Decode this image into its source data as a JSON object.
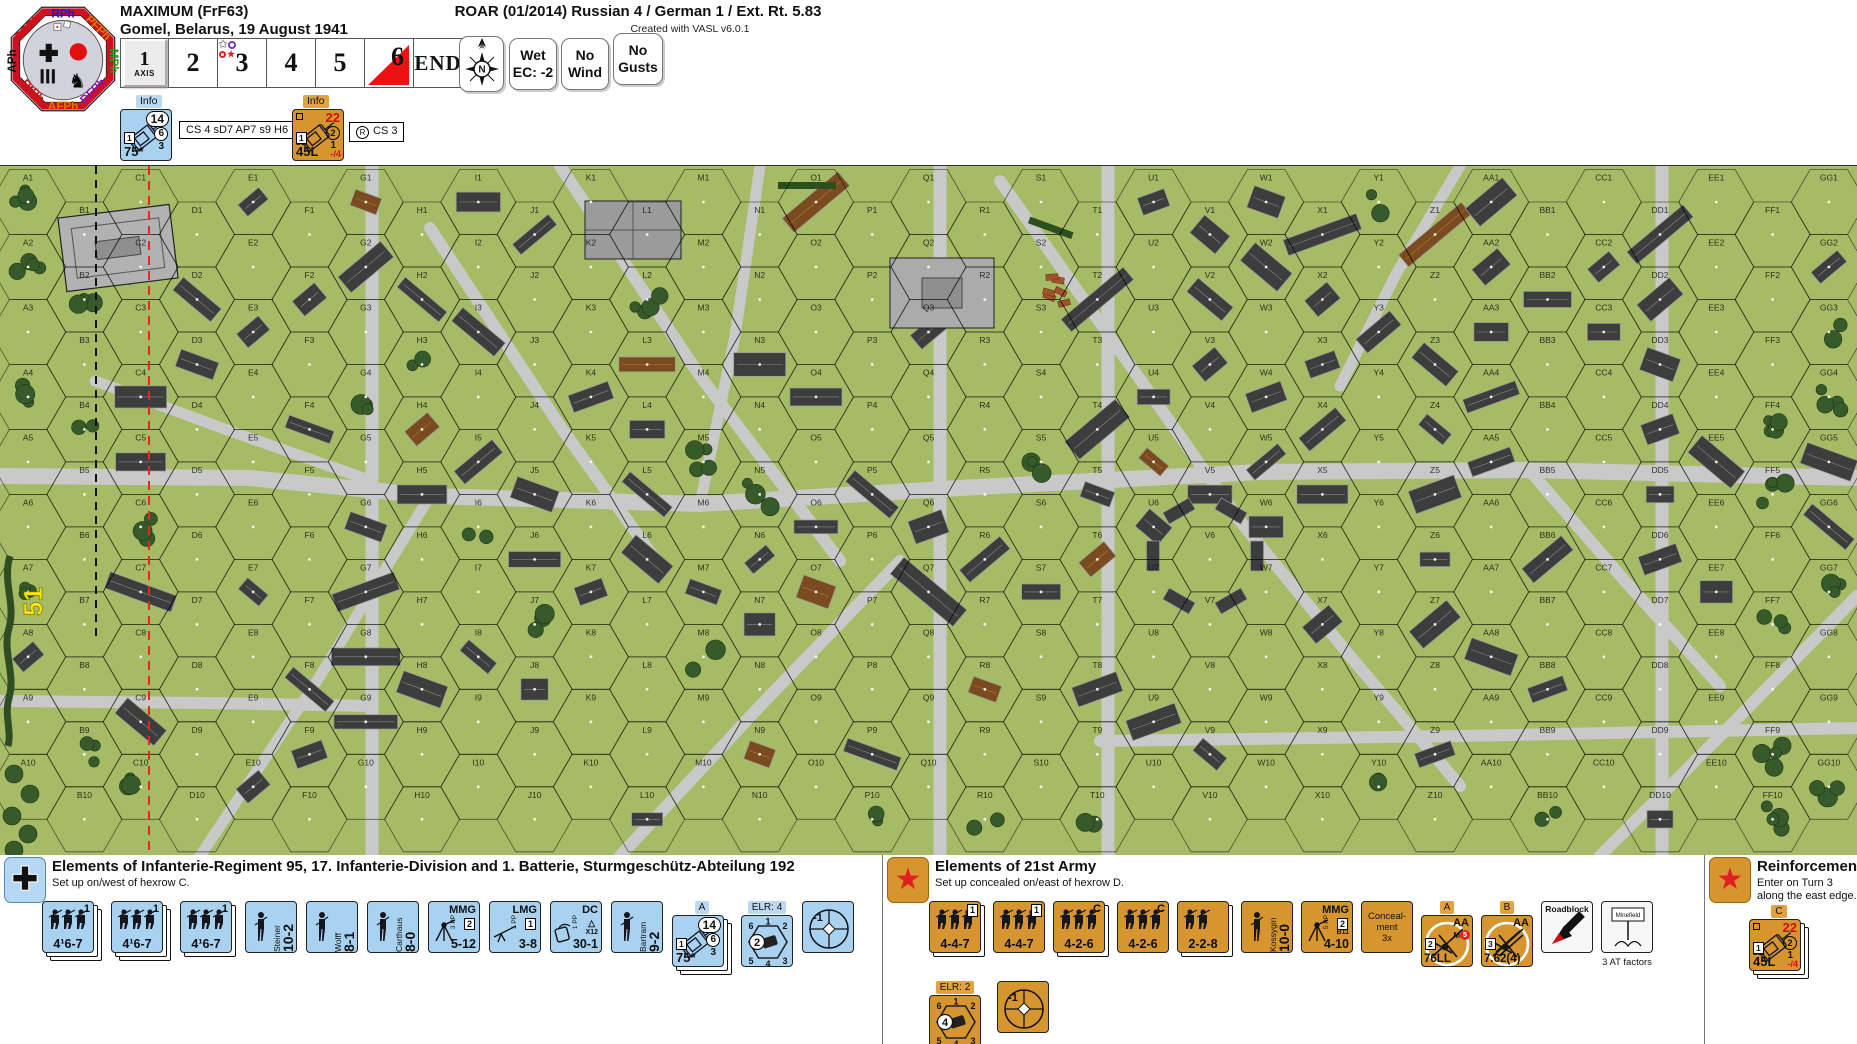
{
  "colors": {
    "map_green": "#a6bb66",
    "road_gray": "#c9c9c9",
    "german_blue": "#a9d2f0",
    "russian_orange": "#d6952f",
    "alert_red": "#e01010"
  },
  "header": {
    "scenario_title": "MAXIMUM (FrF63)",
    "scenario_location": "Gomel, Belarus, 19 August 1941",
    "roar_line": "ROAR (01/2014) Russian 4 / German 1 / Ext. Rt. 5.83",
    "created_with": "Created with VASL v6.0.1",
    "turn_track": {
      "cells": [
        "1",
        "2",
        "3",
        "4",
        "5",
        "6",
        "END"
      ],
      "axis_label": "AXIS",
      "current_turn_cell": "6",
      "reinforcement_turn_cell": "3"
    },
    "weather": {
      "compass": "N",
      "wet": [
        "Wet",
        "EC: -2"
      ],
      "wind": [
        "No",
        "Wind"
      ],
      "gusts": [
        "No",
        "Gusts"
      ]
    },
    "info_german": {
      "label": "Info",
      "counter": {
        "t": "vehicle",
        "stack": 1,
        "pills": [
          "14",
          "6",
          "3"
        ],
        "box": "1",
        "gun": "75*"
      },
      "note": "CS 4  sD7  AP7  s9  H6"
    },
    "info_russian": {
      "label": "Info",
      "counter": {
        "t": "vehicle",
        "stack": 1,
        "red": "22",
        "circ": "2",
        "low": "1",
        "box": "1",
        "sub": "B11",
        "gun": "45L",
        "brk": "-/4"
      },
      "note": "CS 3"
    }
  },
  "phase_wheel": {
    "phases": [
      {
        "label": "RPh",
        "color": "#1818e0"
      },
      {
        "label": "PFPh",
        "color": "#e07800"
      },
      {
        "label": "MPh",
        "color": "#18a018"
      },
      {
        "label": "DFPh",
        "color": "#9010b0"
      },
      {
        "label": "AFPh",
        "color": "#e07800"
      },
      {
        "label": "RtPh",
        "color": "#d01010"
      },
      {
        "label": "APh",
        "color": "#101010"
      },
      {
        "label": "CCPh",
        "color": "#d01010"
      }
    ]
  },
  "map": {
    "columns": [
      "A",
      "B",
      "C",
      "D",
      "E",
      "F",
      "G",
      "H",
      "I",
      "J",
      "K",
      "L",
      "M",
      "N",
      "O",
      "P",
      "Q",
      "R",
      "S",
      "T",
      "U",
      "V",
      "W",
      "X",
      "Y",
      "Z",
      "AA",
      "BB",
      "CC",
      "DD",
      "EE",
      "FF",
      "GG"
    ],
    "rows": 10,
    "edge_label": "51"
  },
  "german_ob": {
    "title": "Elements of Infanterie-Regiment 95, 17. Infanterie-Division and 1. Batterie, Sturmgeschütz-Abteilung 192",
    "setup": "Set up on/west of hexrow C.",
    "counters": [
      {
        "t": "squad",
        "stack": 3,
        "fv": "4¹6-7",
        "badge": "1",
        "boxed": false
      },
      {
        "t": "squad",
        "stack": 3,
        "fv": "4¹6-7",
        "badge": "1",
        "boxed": false
      },
      {
        "t": "squad",
        "stack": 2,
        "fv": "4¹6-7",
        "badge": "1",
        "boxed": false
      },
      {
        "t": "leader",
        "name": "Steiner",
        "rating": "10-2"
      },
      {
        "t": "leader",
        "name": "Wolff",
        "rating": "8-1"
      },
      {
        "t": "leader",
        "name": "Carthaus",
        "rating": "8-0"
      },
      {
        "t": "sw",
        "title": "MMG",
        "pp": "3 PP",
        "box": "2",
        "fv": "5-12"
      },
      {
        "t": "sw",
        "title": "LMG",
        "pp": "1 PP",
        "box": "1",
        "fv": "3-8"
      },
      {
        "t": "sw",
        "title": "DC",
        "pp": "1 PP",
        "extra": "X12",
        "fv": "30-1"
      },
      {
        "t": "leader",
        "name": "Bartram",
        "rating": "9-2"
      },
      {
        "t": "vehicle",
        "label": "A",
        "stack": 3,
        "pills": [
          "14",
          "6",
          "3"
        ],
        "box": "1",
        "gun": "75*"
      },
      {
        "t": "turret",
        "label": "ELR: 4",
        "circ": "2"
      },
      {
        "t": "sniper",
        "val": "-1"
      }
    ]
  },
  "russian_ob": {
    "title": "Elements of 21st Army",
    "setup": "Set up concealed on/east of hexrow D.",
    "counters_row1": [
      {
        "t": "squad",
        "stack": 2,
        "fv": "4-4-7",
        "badge": "1",
        "boxed": true
      },
      {
        "t": "squad",
        "stack": 1,
        "fv": "4-4-7",
        "badge": "1",
        "boxed": true
      },
      {
        "t": "squad",
        "stack": 2,
        "fv": "4-2-6",
        "badge": "C",
        "boxed": false
      },
      {
        "t": "squad",
        "stack": 1,
        "fv": "4-2-6",
        "badge": "C",
        "boxed": false
      },
      {
        "t": "squad",
        "stack": 2,
        "fv": "2-2-8",
        "badge": "",
        "boxed": false,
        "crew": true
      },
      {
        "t": "leader",
        "name": "Kossygin",
        "rating": "10-0"
      },
      {
        "t": "sw",
        "title": "MMG",
        "pp": "5 PP",
        "box": "2",
        "extra": "B11",
        "fv": "4-10"
      },
      {
        "t": "marker",
        "lines": [
          "Conceal-",
          "ment",
          "3x"
        ]
      },
      {
        "t": "gun",
        "label": "A",
        "aa": "AA",
        "m": "M",
        "mval": "5",
        "box": "2",
        "gun": "76LL"
      },
      {
        "t": "gun",
        "label": "B",
        "aa": "AA",
        "box": "3",
        "gun": "7.62(4)"
      },
      {
        "t": "roadblock",
        "title": "Roadblock"
      },
      {
        "t": "minefield",
        "title": "Minefield",
        "note": "3 AT factors"
      }
    ],
    "counters_row2": [
      {
        "t": "turret",
        "label": "ELR: 2",
        "circ": "4"
      },
      {
        "t": "sniper",
        "val": "-1"
      }
    ]
  },
  "reinforcements": {
    "title": "Reinforcements",
    "line1": "Enter on Turn 3",
    "line2": "along the east edge.",
    "counter": {
      "t": "vehicle",
      "label": "C",
      "stack": 3,
      "red": "22",
      "circ": "2",
      "low": "1",
      "box": "1",
      "sub": "B11",
      "gun": "45L",
      "brk": "-/4"
    }
  }
}
